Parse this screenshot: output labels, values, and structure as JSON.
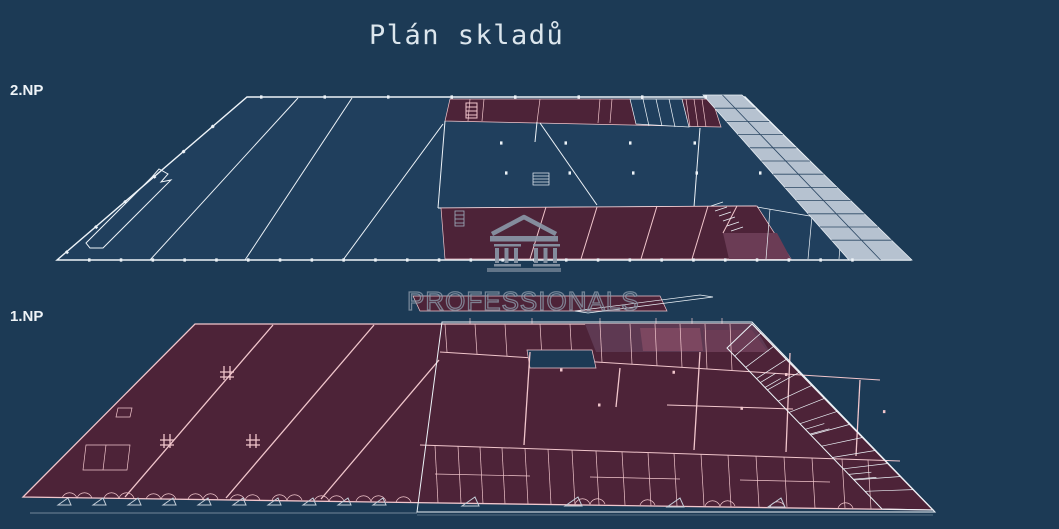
{
  "title": "Plán skladů",
  "floors": [
    {
      "id": "2np",
      "label": "2.NP"
    },
    {
      "id": "1np",
      "label": "1.NP"
    }
  ],
  "watermark": {
    "text": "PROFESSIONALS",
    "icon": "temple-building-icon"
  },
  "colors": {
    "bg": "#1c3a55",
    "plan-navy": "#203f5d",
    "maroon": "#4d2338",
    "maroon-light": "#6b3c55",
    "maroon-accent": "#7c4760",
    "pink": "#f1c6cc",
    "white-line": "#edf3f8",
    "gray-fill": "#b6c2d0",
    "gray-line": "#2b4763",
    "watermark-gray": "#8b98a8",
    "title-color": "#dce6ed",
    "label-color": "#eef3f7",
    "triangle-color": "#c3cdd8"
  }
}
